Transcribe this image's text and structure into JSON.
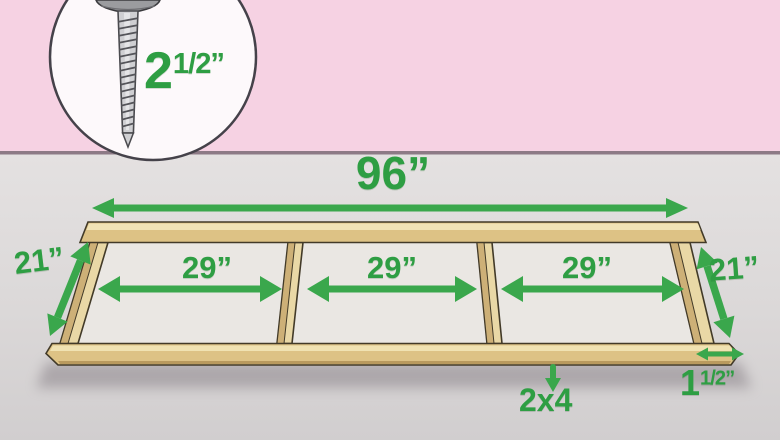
{
  "illustration": {
    "inset": {
      "icon": "screw-icon",
      "screw_length": {
        "whole": "2",
        "fraction": "1/2",
        "unit": "”"
      }
    },
    "dimensions": {
      "overall_width": "96”",
      "bay_widths": [
        "29”",
        "29”",
        "29”"
      ],
      "left_depth": "21”",
      "right_depth": "21”",
      "board_thickness": {
        "whole": "1",
        "fraction": "1/2",
        "unit": "”"
      },
      "lumber_size": "2x4"
    },
    "colors": {
      "wall_pink": "#f6d2e3",
      "floor_gray": "#dedbdb",
      "annotation_green": "#2e9e43",
      "wood_tan": "#ddc285"
    }
  }
}
